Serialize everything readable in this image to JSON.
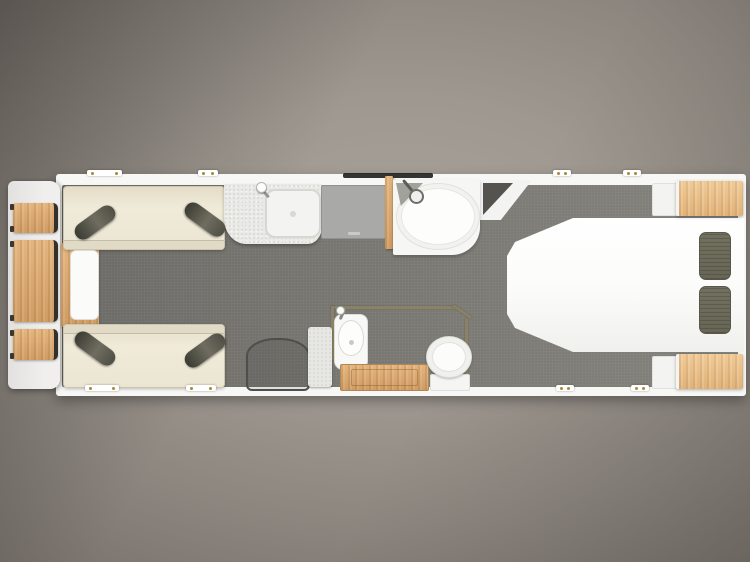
{
  "scene": {
    "type": "caravan-floorplan-top-view",
    "description": "Top-down rendered floor plan of a touring caravan on a grey studio vignette background",
    "background_style": "grey radial vignette, darker top-left corner"
  },
  "colors": {
    "bg-center": "#a9a39b",
    "bg-edge": "#5e5954",
    "body-white": "#f7f7f5",
    "front-panel": "#eeedeb",
    "floor-dark": "#6b6965",
    "floor-light": "#81807a",
    "sofa-cream": "#ebe5d3",
    "sofa-trim": "#cdc6ae",
    "cushion-dark": "#56554b",
    "wood": "#cf9c63",
    "wood-light": "#e4b57e",
    "counter": "#e9e9e6",
    "hob": "#a9a9a7",
    "fixture-white": "#fcfcfb",
    "wall-olive": "#8b8164",
    "window-brass": "#a58a3a",
    "rooflight": "#1e1e1e"
  },
  "areas": {
    "front_storage": {
      "label": "Front lockers / shelves",
      "locker_count": 3
    },
    "lounge": {
      "label": "Front lounge",
      "sofas": 2,
      "bolster_cushions": 4,
      "chest": "front chest with table top"
    },
    "kitchen": {
      "label": "Kitchen",
      "items": [
        "worktop",
        "sink",
        "tap",
        "hob",
        "rooflight"
      ]
    },
    "shower": {
      "label": "Shower cubicle",
      "items": [
        "quadrant shower tray",
        "mixer fixture"
      ]
    },
    "washroom": {
      "label": "Washroom",
      "items": [
        "washbasin",
        "vanity counter",
        "toilet"
      ]
    },
    "entrance": {
      "label": "Entrance door mat"
    },
    "bedroom": {
      "label": "Rear bedroom",
      "items": [
        "island bed",
        "pillows x2",
        "bedside lockers x2",
        "corner wardrobe"
      ],
      "pillows": 2
    }
  },
  "window_markers": {
    "count": 8,
    "hinge_color": "#a58a3a"
  }
}
